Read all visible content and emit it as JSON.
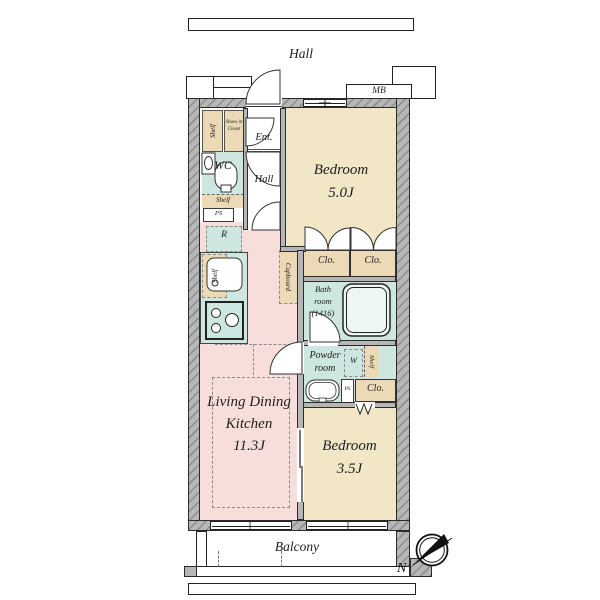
{
  "colors": {
    "ldk_floor": "#f8dedb",
    "bedroom_floor": "#f1e7c6",
    "wet_area_floor": "#cde6e0",
    "storage_fill": "#ecd9b6",
    "wall_gray": "#b6b6b6"
  },
  "exterior": {
    "corridor": "Hall",
    "meter_box": "MB",
    "balcony": "Balcony",
    "compass_north": "N"
  },
  "rooms": {
    "ldk": {
      "name_line1": "Living Dining",
      "name_line2": "Kitchen",
      "size": "11.3J"
    },
    "bedroom_main": {
      "name": "Bedroom",
      "size": "5.0J"
    },
    "bedroom_second": {
      "name": "Bedroom",
      "size": "3.5J"
    },
    "bath": {
      "name_line1": "Bath",
      "name_line2": "room",
      "name_line3": "(1416)"
    },
    "powder": {
      "name_line1": "Powder",
      "name_line2": "room"
    },
    "wc": {
      "name": "WC"
    },
    "entrance": {
      "name": "Ent."
    },
    "hall": {
      "name": "Hall"
    }
  },
  "storage": {
    "entry_shelf": "Shelf",
    "shoes_closet_line1": "Shoes in",
    "shoes_closet_line2": "Closet",
    "wc_shelf": "Shelf",
    "kitchen_shelf": "Shelf",
    "cupboard": "Cupboard",
    "closet_a": "Clo.",
    "closet_b": "Clo.",
    "closet_c": "Clo.",
    "powder_shelf": "Shelf"
  },
  "equipment": {
    "refrigerator": "R",
    "washer": "W",
    "pipe_space_upper": "PS",
    "pipe_space_lower": "PS"
  }
}
